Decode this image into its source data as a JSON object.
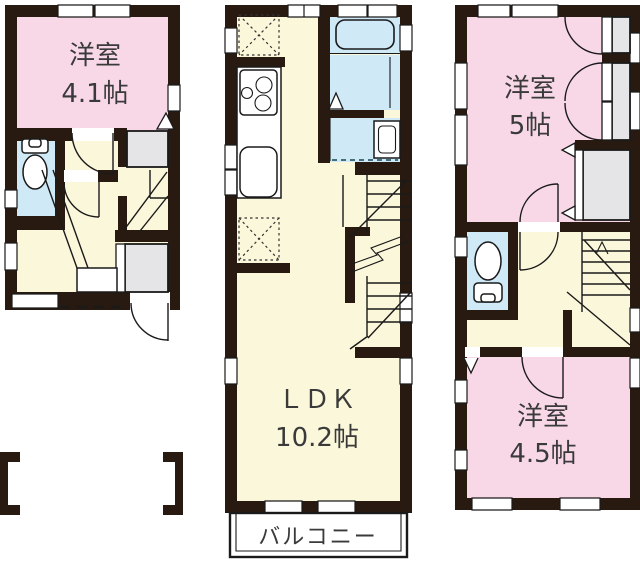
{
  "floorplan": {
    "rooms": {
      "room_1f": {
        "name": "洋室",
        "size": "4.1帖"
      },
      "ldk": {
        "name": "ＬＤＫ",
        "size": "10.2帖"
      },
      "balcony": {
        "name": "バルコニー"
      },
      "room_3f_a": {
        "name": "洋室",
        "size": "5帖"
      },
      "room_3f_b": {
        "name": "洋室",
        "size": "4.5帖"
      }
    },
    "colors": {
      "wall": "#281a10",
      "room_pink": "#f8d8e7",
      "floor_cream": "#fbf7da",
      "wet_area_blue": "#cfe9f6",
      "closet_gray": "#e5e5e7",
      "line": "#1a1a1a",
      "background": "#ffffff",
      "label_text": "#3a3a3a"
    }
  }
}
